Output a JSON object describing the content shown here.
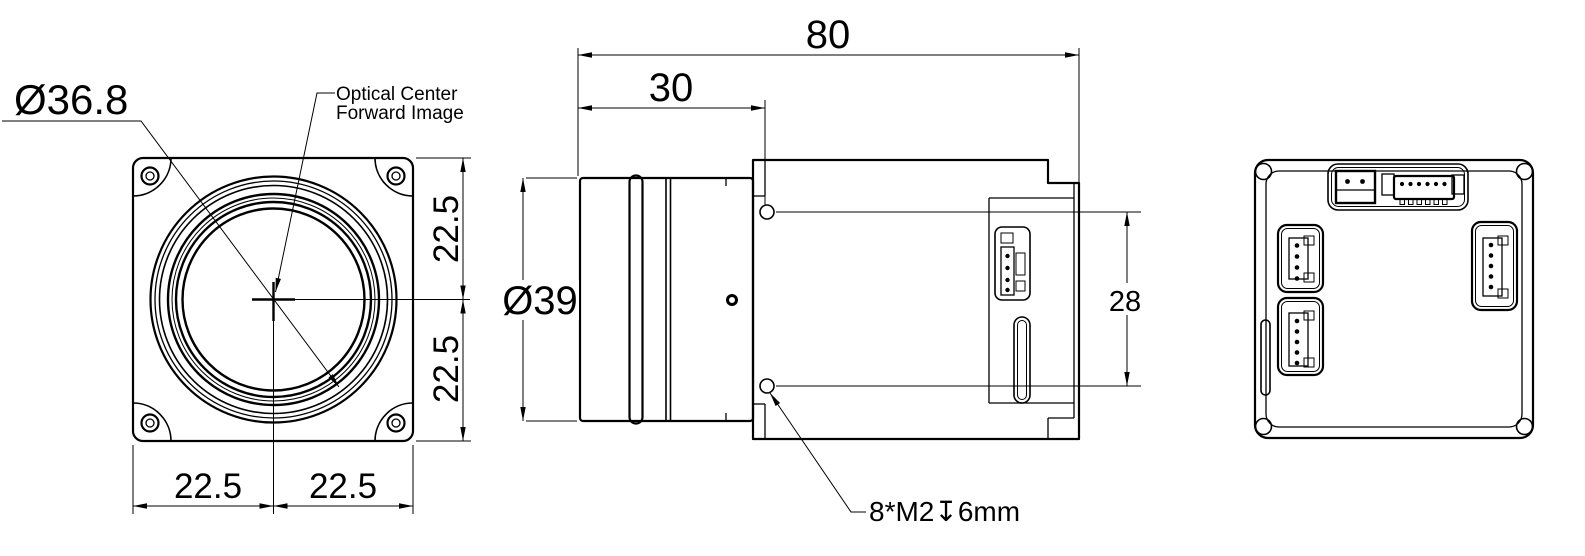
{
  "drawing": {
    "description": "Mechanical dimension drawing of a camera core module shown in three orthographic views",
    "background_color": "#ffffff",
    "line_color": "#000000",
    "views": {
      "front": "front view",
      "side": "side view",
      "rear": "rear view"
    }
  },
  "front": {
    "lens_diameter": "Ø36.8",
    "optical_label_line1": "Optical Center",
    "optical_label_line2": "Forward Image",
    "dim_right_upper": "22.5",
    "dim_right_lower": "22.5",
    "dim_bottom_left": "22.5",
    "dim_bottom_right": "22.5"
  },
  "side": {
    "dim_overall_length": "80",
    "dim_lens_length": "30",
    "dim_lens_diameter": "Ø39",
    "dim_hole_spacing": "28",
    "thread_note": "8*M2↧6mm"
  }
}
